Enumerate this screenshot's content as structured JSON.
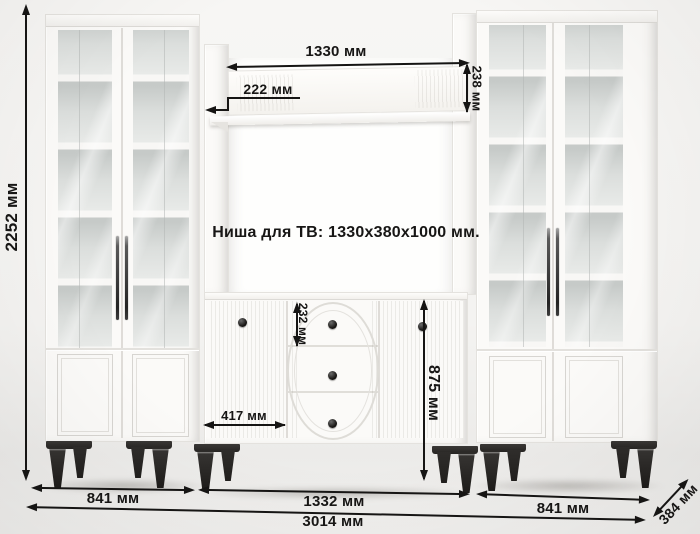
{
  "product": {
    "type": "wall-unit furniture dimension diagram",
    "niche_note": "Ниша для ТВ: 1330x380x1000 мм."
  },
  "dims": {
    "overall_height": "2252 мм",
    "shelf_length": "1330 мм",
    "shelf_depth": "222 мм",
    "shelf_panel_height": "238 мм",
    "top_drawer_height": "232 мм",
    "chest_height": "875 мм",
    "chest_door_width": "417 мм",
    "left_cabinet_width": "841 мм",
    "center_section_width": "1332 мм",
    "right_cabinet_width": "841 мм",
    "overall_width": "3014 мм",
    "overall_depth": "384 мм"
  },
  "colors": {
    "dimension_ink": "#161514",
    "furniture_white": "#fbfaf8",
    "glass_tint": "#dfe2e0",
    "feet_black": "#262422",
    "background": "#f4f3f1"
  }
}
